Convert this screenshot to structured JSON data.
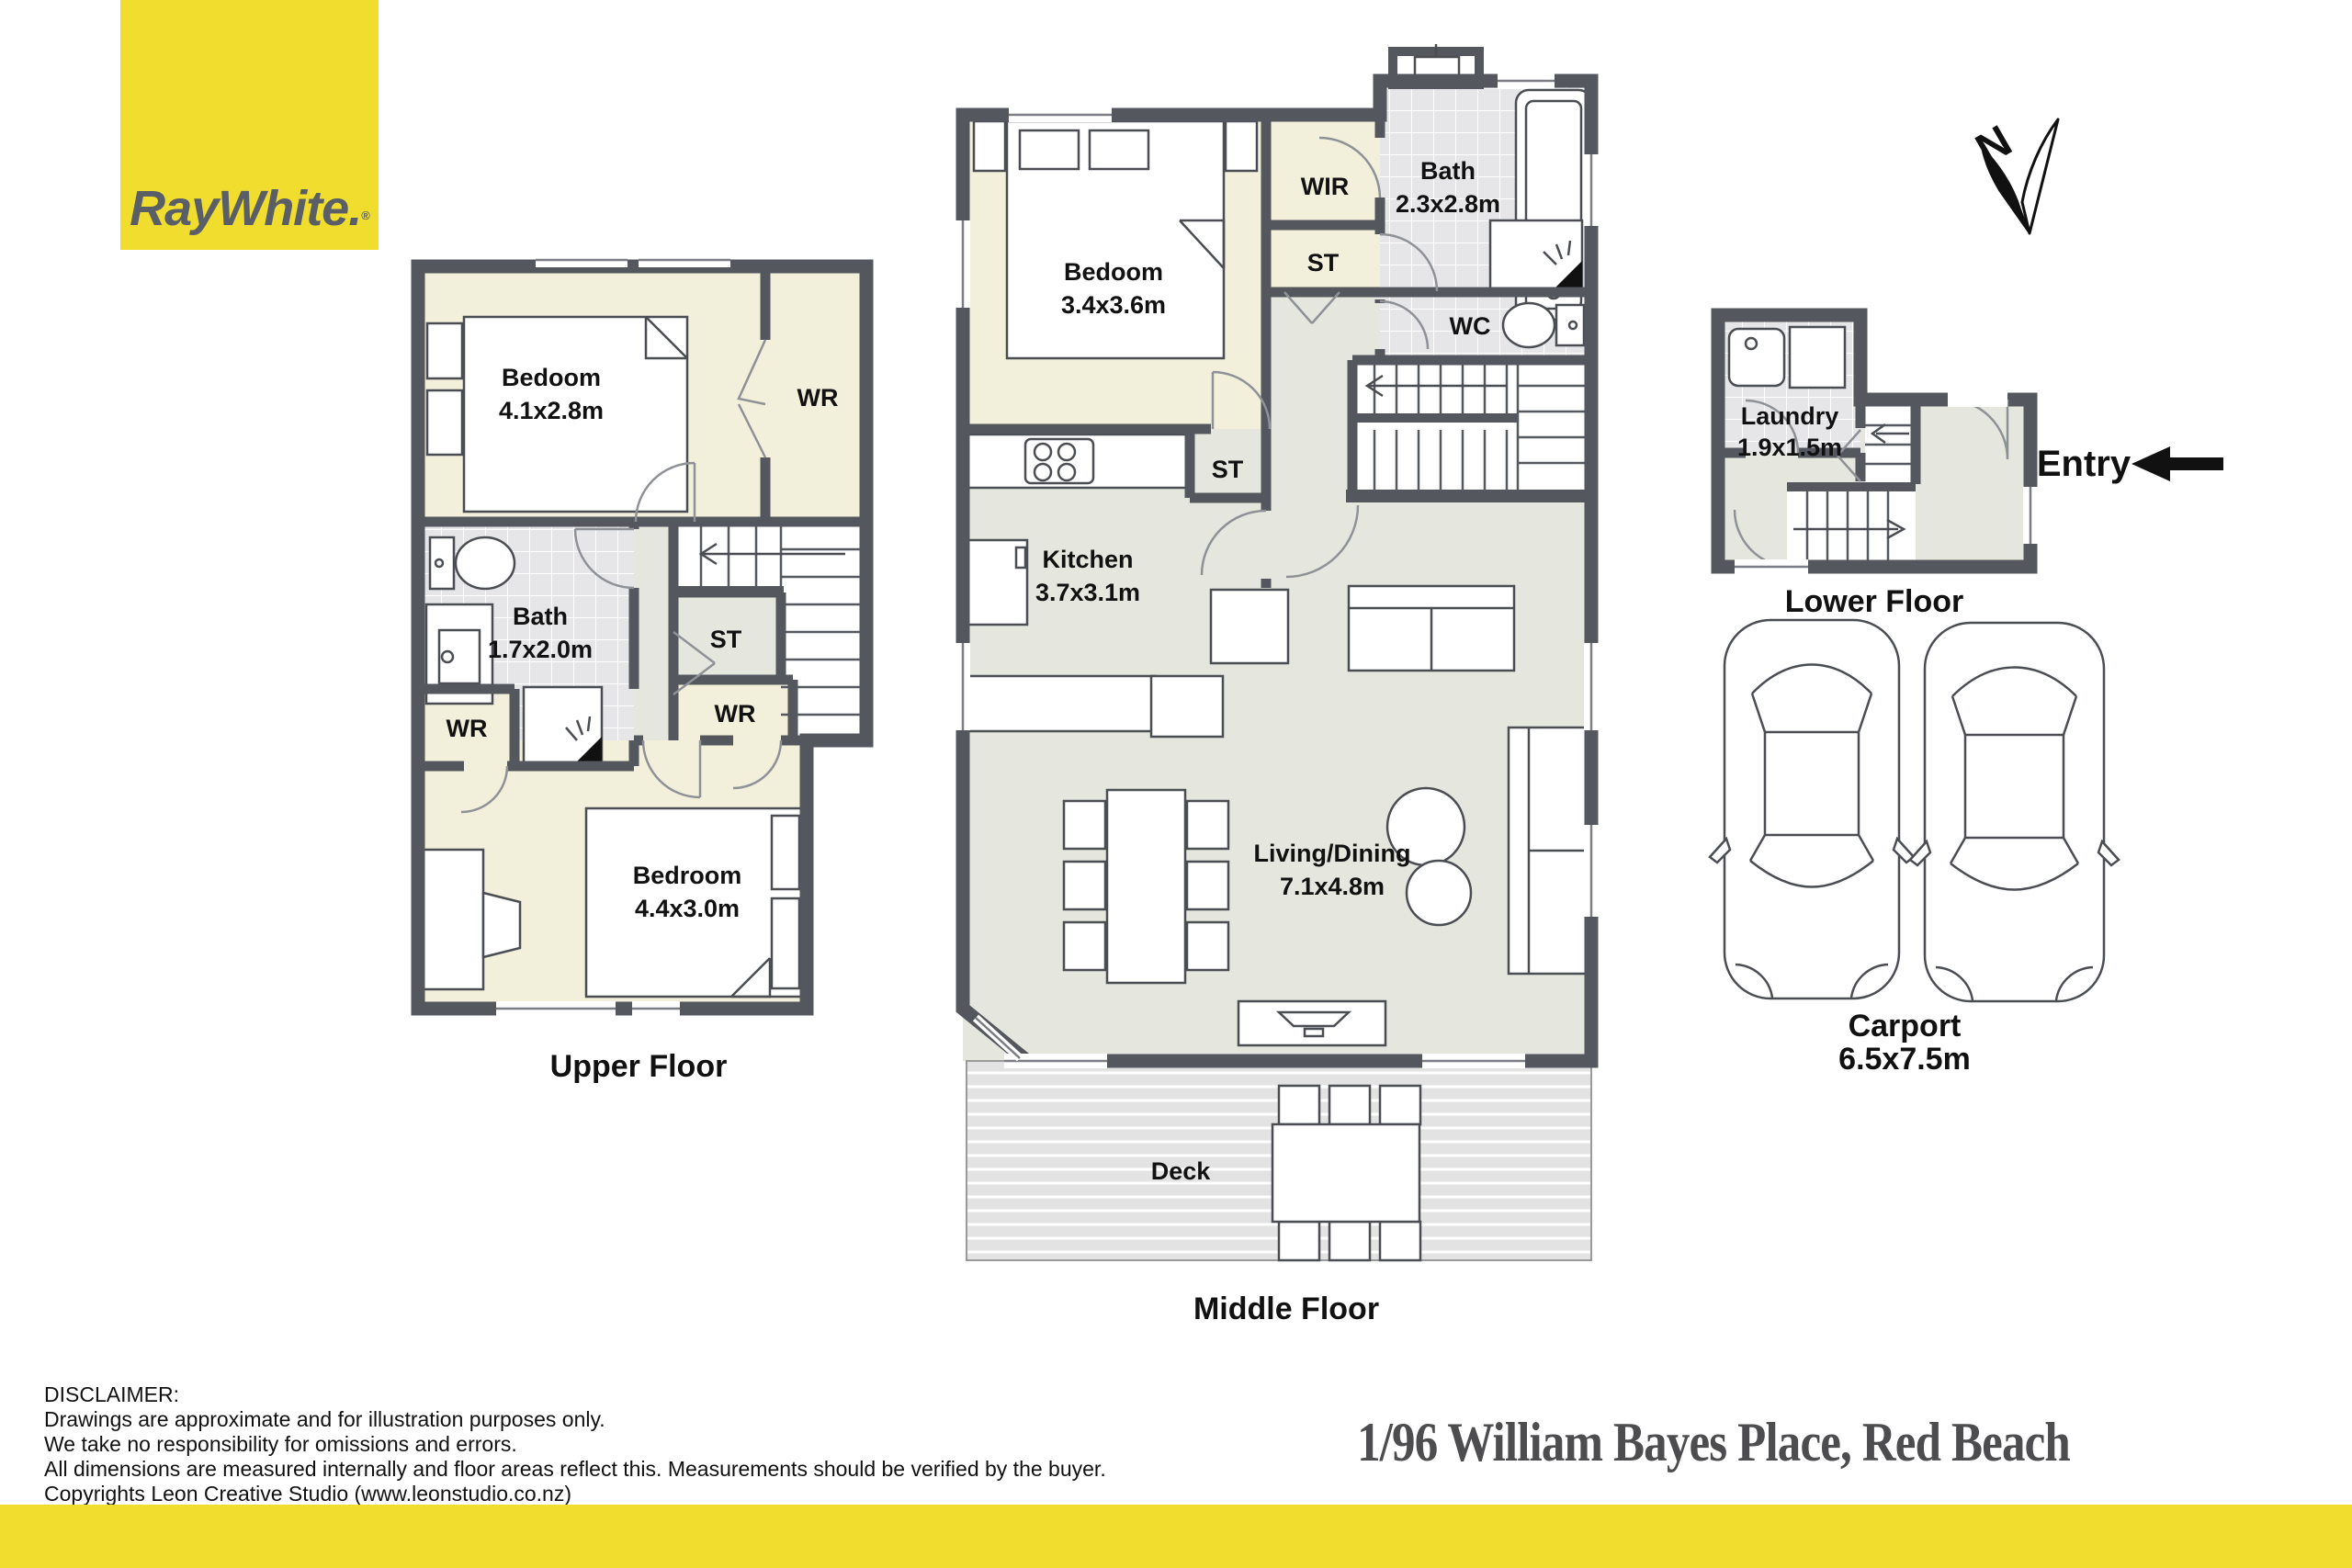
{
  "branding": {
    "logo_text": "RayWhite",
    "logo_dot": ".",
    "reg_mark": "®",
    "brand_yellow": "#f0dd2d",
    "logo_text_color": "#5a5e66"
  },
  "compass": {
    "label": "N"
  },
  "entry": {
    "label": "Entry"
  },
  "floors": {
    "upper": {
      "caption": "Upper Floor",
      "rooms": {
        "bedroom1": {
          "name": "Bedoom",
          "dims": "4.1x2.8m"
        },
        "wr1": {
          "name": "WR"
        },
        "bath": {
          "name": "Bath",
          "dims": "1.7x2.0m"
        },
        "st": {
          "name": "ST"
        },
        "wr2": {
          "name": "WR"
        },
        "wr3": {
          "name": "WR"
        },
        "bedroom2": {
          "name": "Bedroom",
          "dims": "4.4x3.0m"
        }
      }
    },
    "middle": {
      "caption": "Middle Floor",
      "rooms": {
        "bedroom": {
          "name": "Bedoom",
          "dims": "3.4x3.6m"
        },
        "wir": {
          "name": "WIR"
        },
        "st1": {
          "name": "ST"
        },
        "bath": {
          "name": "Bath",
          "dims": "2.3x2.8m"
        },
        "wc": {
          "name": "WC"
        },
        "st2": {
          "name": "ST"
        },
        "kitchen": {
          "name": "Kitchen",
          "dims": "3.7x3.1m"
        },
        "living": {
          "name": "Living/Dining",
          "dims": "7.1x4.8m"
        },
        "deck": {
          "name": "Deck"
        }
      }
    },
    "lower": {
      "caption": "Lower Floor",
      "rooms": {
        "laundry": {
          "name": "Laundry",
          "dims": "1.9x1.5m"
        }
      }
    },
    "carport": {
      "caption": "Carport",
      "dims": "6.5x7.5m"
    }
  },
  "footer": {
    "address": "1/96 William Bayes Place, Red Beach",
    "disclaimer": [
      "DISCLAIMER:",
      "Drawings are approximate and for illustration purposes only.",
      "We take no responsibility for omissions and errors.",
      "All dimensions are measured internally and floor areas reflect this. Measurements should be verified by the buyer.",
      "Copyrights Leon Creative Studio (www.leonstudio.co.nz)"
    ]
  },
  "colors": {
    "wall": "#54575e",
    "room_cream": "#f2efdb",
    "floor_green": "#e5e7de",
    "tile": "#e6e6e9",
    "deck": "#e3e3e3"
  }
}
